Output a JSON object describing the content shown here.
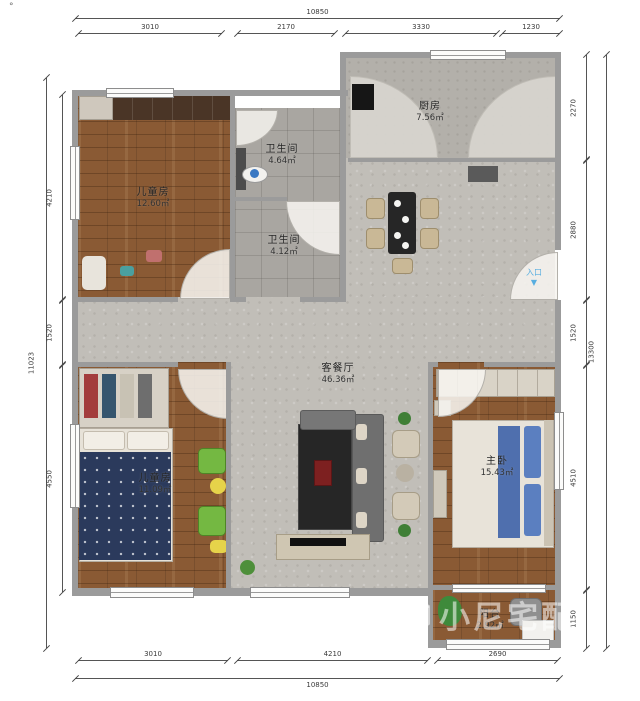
{
  "page": {
    "corner_mark": "°"
  },
  "rooms": [
    {
      "name": "厨房",
      "area": "7.56㎡"
    },
    {
      "name": "卫生间",
      "area": "4.64㎡"
    },
    {
      "name": "卫生间",
      "area": "4.12㎡"
    },
    {
      "name": "儿童房",
      "area": "12.60㎡"
    },
    {
      "name": "客餐厅",
      "area": "46.36㎡"
    },
    {
      "name": "儿童房",
      "area": "11.09㎡"
    },
    {
      "name": "主卧",
      "area": "15.43㎡"
    },
    {
      "name": "阳台",
      "area": "2.92㎡"
    }
  ],
  "dimensions": {
    "top": {
      "total": "10850",
      "segments": [
        "3010",
        "2170",
        "3330",
        "1230"
      ]
    },
    "bottom": {
      "total": "10850",
      "segments": [
        "3010",
        "4210",
        "2690"
      ]
    },
    "left": {
      "total": "11023",
      "segments": [
        "4210",
        "1520",
        "4550"
      ]
    },
    "right": {
      "total": "13300",
      "segments": [
        "2270",
        "2880",
        "1520",
        "4510",
        "1150"
      ]
    }
  },
  "entry": {
    "label": "入口",
    "arrow": "▼"
  },
  "watermark": {
    "text": "小尼宅配"
  },
  "colors": {
    "wall": "#9b9b9b",
    "wood_floor": "#8a5a34",
    "tile_floor": "#c1beb8",
    "bath_tile": "#a9a6a1",
    "kitchen_tile": "#b3b0aa",
    "entry_blue": "#58aee0",
    "dim_text": "#3a3a3a"
  }
}
